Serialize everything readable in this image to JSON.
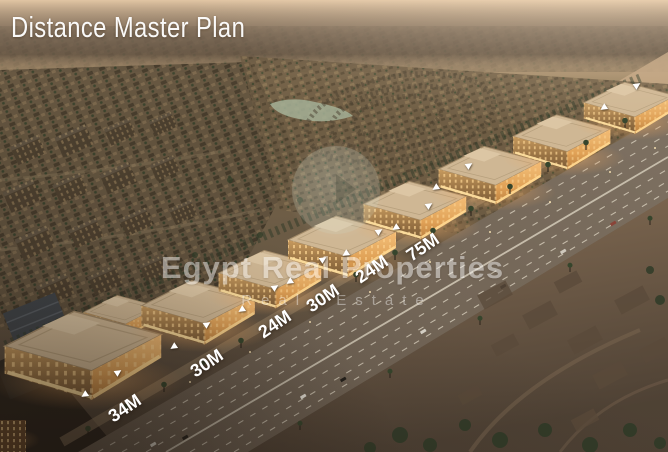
{
  "title": "Distance Master Plan",
  "watermark": {
    "line1": "Egypt Real Properties",
    "line2": "Real Estate"
  },
  "measurements": [
    {
      "label": "34M"
    },
    {
      "label": "30M"
    },
    {
      "label": "24M"
    },
    {
      "label": "30M"
    },
    {
      "label": "24M"
    },
    {
      "label": "75M"
    }
  ],
  "icons": {
    "arrow_left": "◀",
    "arrow_right": "▶",
    "watermark_logo": "circle-logo"
  },
  "colors": {
    "title_text": "#ffffff",
    "distance_label_text": "#ffffff",
    "watermark_text": "#ffffff",
    "building_glow": "#ffc87e",
    "road_surface": "#6e6253",
    "haze": "#d9bf9f"
  }
}
